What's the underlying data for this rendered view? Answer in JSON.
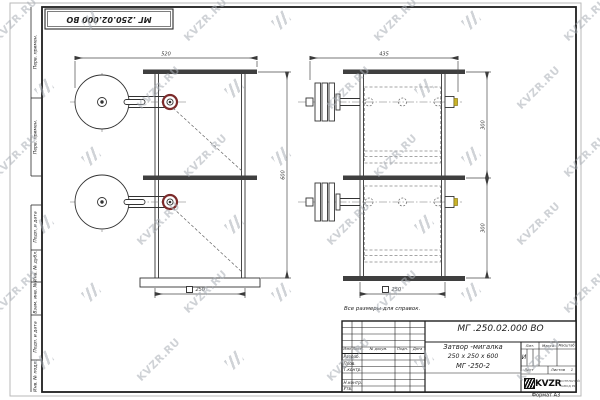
{
  "sheet": {
    "note": "Все размеры для справок.",
    "format_label": "Формат А3",
    "corner_stamp": "МГ .250.02.000 ВО"
  },
  "side_columns": [
    "Перв. примен.",
    "Перв. примен.",
    "Подп. и дата",
    "Инв. № дубл.",
    "Взам. инв. №",
    "Подп. и дата",
    "Инв. № подл."
  ],
  "title_block": {
    "designation": "МГ .250.02.000 ВО",
    "product_name": "Затвор -мигалка",
    "product_size": "250 x 250 x 600",
    "product_code": "МГ -250-2",
    "table_headers": [
      "Изм",
      "Лист",
      "№ докум.",
      "Подп.",
      "Дата"
    ],
    "signature_rows": [
      "Разраб.",
      "Пров.",
      "Т.контр.",
      "Н.контр.",
      "Утв."
    ],
    "lit_label": "Лит.",
    "lit_value": "И",
    "mass_label": "Масса",
    "scale_label": "Масштаб",
    "sheet_label": "Лист",
    "sheets_label": "Листов",
    "sheets_value": "1",
    "logo_text": "KVZR",
    "logo_sub1": "КОТЕЛЬНЫЙ",
    "logo_sub2": "ЗАВОД РФ"
  },
  "dimensions": {
    "front_width": "520",
    "front_height": "600",
    "front_bottom": "250",
    "side_width": "435",
    "side_section1": "300",
    "side_section2": "300",
    "side_bottom": "250"
  },
  "watermark": {
    "text": "KVZR.RU",
    "color": "#a9afb6",
    "rows": 6,
    "cols": 7
  }
}
